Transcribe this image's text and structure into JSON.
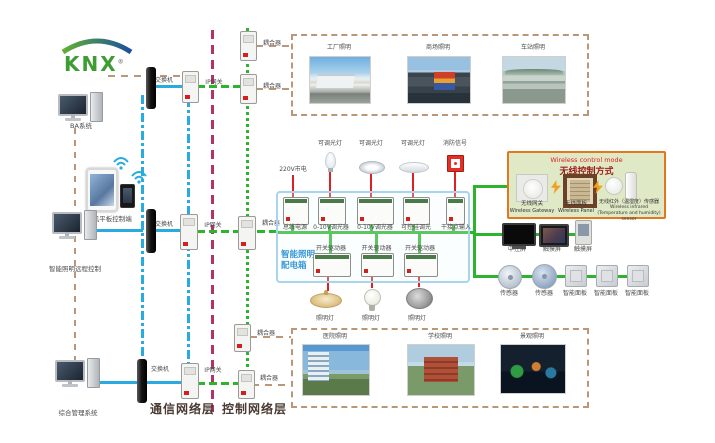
{
  "logo": {
    "text": "KNX",
    "registered": "®"
  },
  "left": {
    "computers": [
      {
        "label": "BA系统"
      },
      {
        "label": "智能照明远程控制"
      },
      {
        "label": "综合管理系统"
      }
    ],
    "mobile_label": "手机平板控制端"
  },
  "network": {
    "switch_labels": [
      "交换机",
      "交换机",
      "交换机"
    ],
    "gateway_labels": [
      "IP网关",
      "IP网关",
      "IP网关"
    ],
    "coupler_labels": [
      "耦合器",
      "耦合器",
      "耦合器",
      "耦合器",
      "耦合器"
    ],
    "layer_communication": "通信网络层",
    "layer_control": "控制网络层"
  },
  "photos": {
    "top": [
      {
        "label": "工厂照明"
      },
      {
        "label": "商场照明"
      },
      {
        "label": "车站照明"
      }
    ],
    "bottom": [
      {
        "label": "医院照明"
      },
      {
        "label": "学校照明"
      },
      {
        "label": "景观照明"
      }
    ]
  },
  "dist_box": {
    "title_lines": [
      "智能照明",
      "配电箱"
    ],
    "power_label": "220V市电",
    "load_labels": [
      "可调光灯",
      "可调光灯",
      "可调光灯",
      "消防信号"
    ],
    "top_devices": [
      "总线电源",
      "0-10V调光器",
      "0-10V调光器",
      "可控硅调光",
      "干接点输入"
    ],
    "actuators": [
      "开关驱动器",
      "开关驱动器",
      "开关驱动器"
    ],
    "lamp_labels": [
      "照明灯",
      "照明灯",
      "照明灯"
    ]
  },
  "wireless": {
    "title_en": "Wireless control mode",
    "title_cn": "无线控制方式",
    "devices": [
      {
        "cn": "无线网关",
        "en": "Wireless Gateway"
      },
      {
        "cn": "无线面板",
        "en": "Wireless Panel"
      },
      {
        "cn": "无线红外（温湿度）传感器",
        "en": "Wireless infrared (Temperature and humidity) sensor"
      }
    ]
  },
  "right_devices": {
    "screens": [
      "中控屏",
      "触摸屏",
      "触摸屏"
    ],
    "field": [
      "传感器",
      "传感器",
      "智能面板",
      "智能面板",
      "智能面板"
    ]
  },
  "colors": {
    "bus_blue": "#29abe2",
    "bus_green": "#2db42d",
    "bus_red": "#e02020",
    "bus_magenta": "#b03468",
    "bus_tan": "#b89878",
    "dist_box_border": "#a8d4ec",
    "wireless_border": "#e07820",
    "wireless_bg": "#dfe9c6"
  }
}
